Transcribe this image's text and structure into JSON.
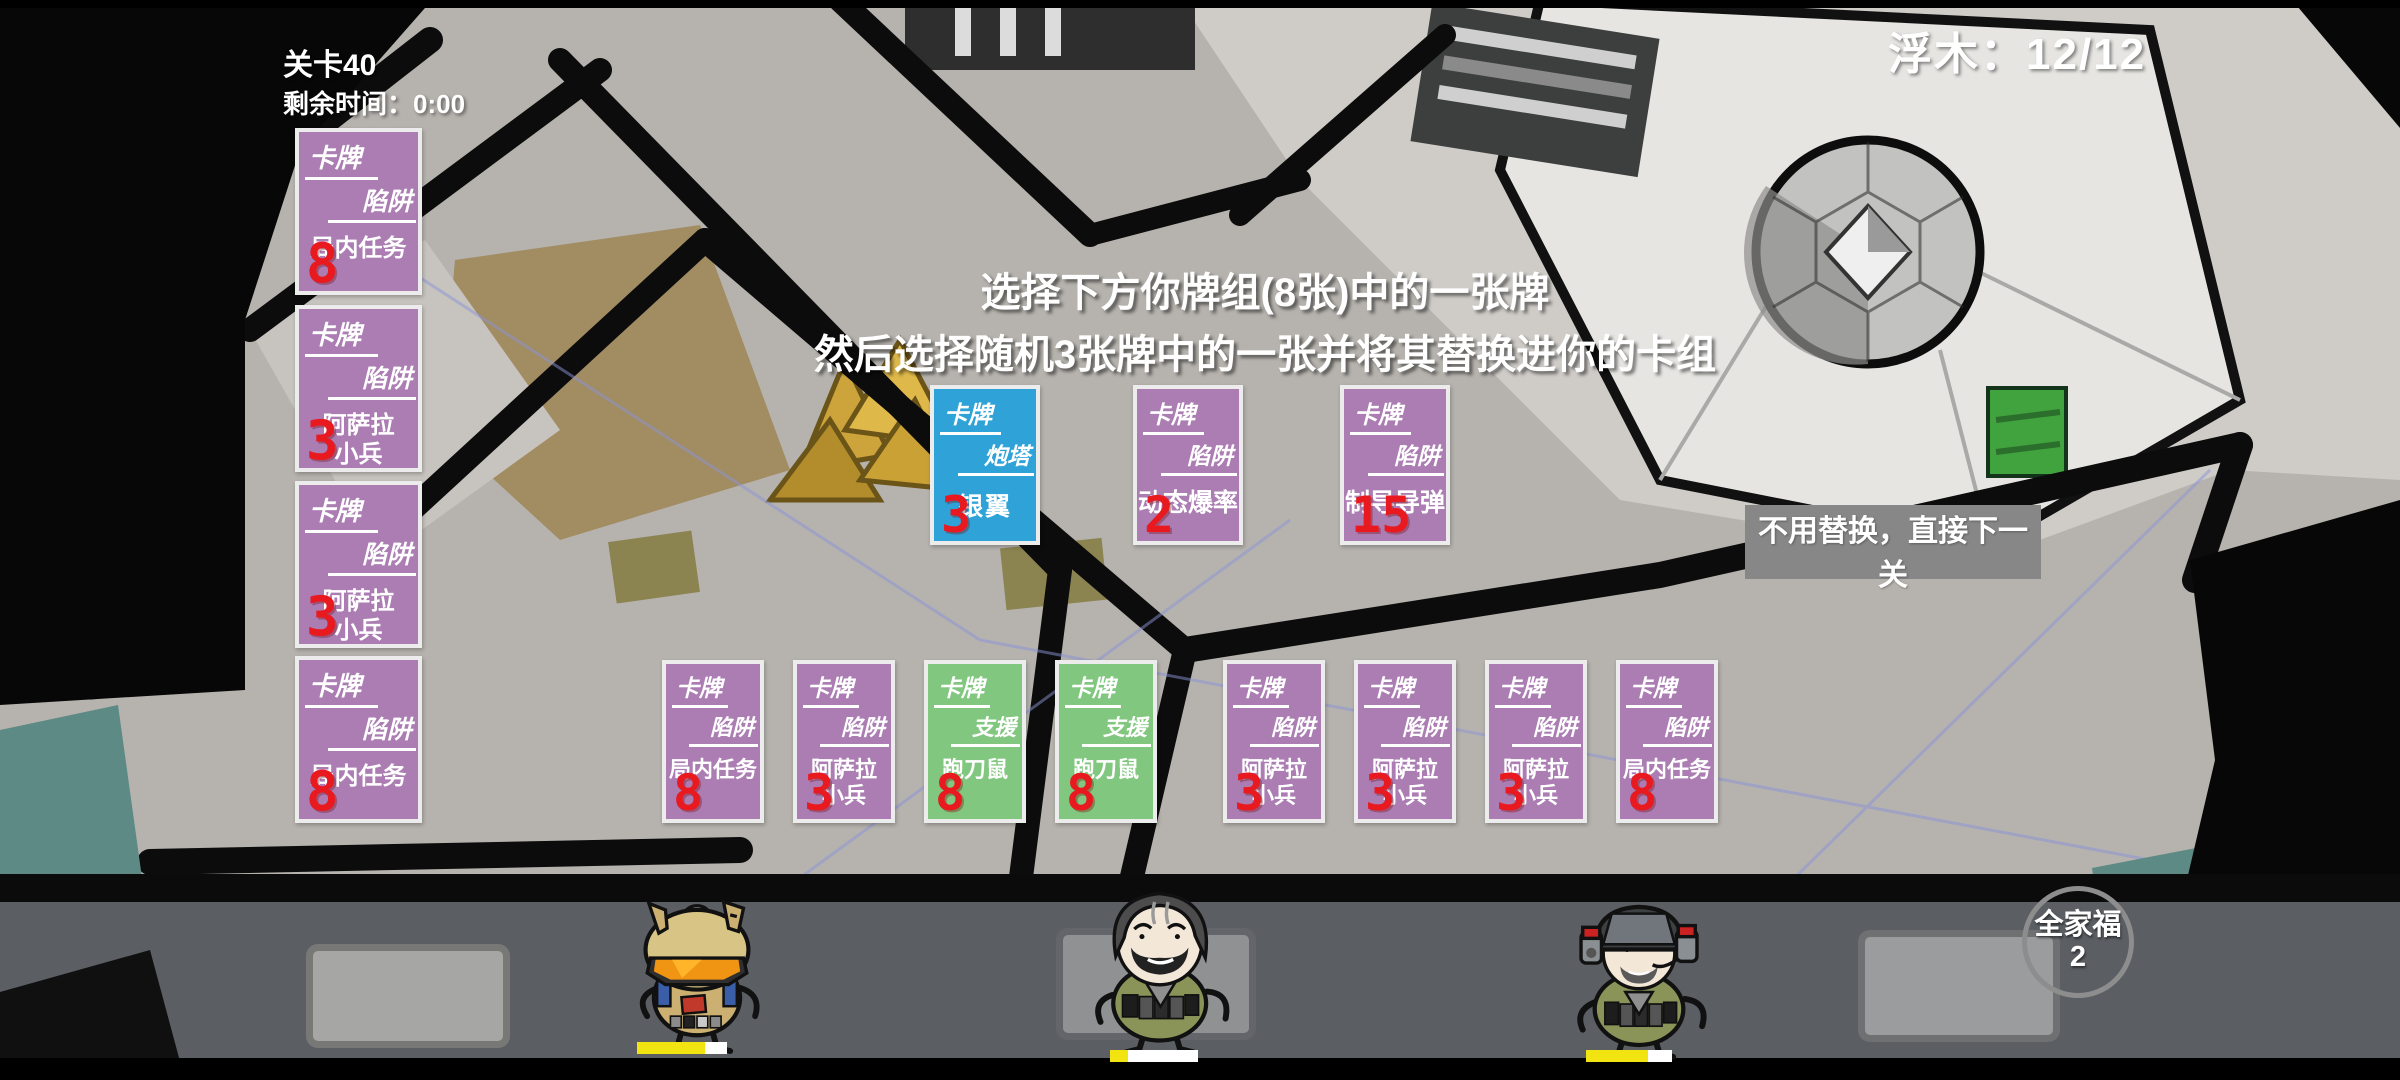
{
  "hud": {
    "level": "关卡40",
    "time": "剩余时间：0:00",
    "driftwood": "浮木：12/12"
  },
  "instruction": {
    "line1": "选择下方你牌组(8张)中的一张牌",
    "line2": "然后选择随机3张牌中的一张并将其替换进你的卡组"
  },
  "skip_button_label": "不用替换，直接下一关",
  "family_badge": {
    "label": "全家福",
    "count": "2"
  },
  "reserve_cards": [
    {
      "category": "卡牌",
      "type": "陷阱",
      "name": "局内任务",
      "name2": "",
      "count": "8"
    },
    {
      "category": "卡牌",
      "type": "陷阱",
      "name": "阿萨拉",
      "name2": "小兵",
      "count": "3"
    },
    {
      "category": "卡牌",
      "type": "陷阱",
      "name": "阿萨拉",
      "name2": "小兵",
      "count": "3"
    },
    {
      "category": "卡牌",
      "type": "陷阱",
      "name": "局内任务",
      "name2": "",
      "count": "8"
    }
  ],
  "offer_cards": [
    {
      "category": "卡牌",
      "type": "炮塔",
      "name": "银翼",
      "name2": "",
      "count": "3"
    },
    {
      "category": "卡牌",
      "type": "陷阱",
      "name": "动态爆率",
      "name2": "",
      "count": "2"
    },
    {
      "category": "卡牌",
      "type": "陷阱",
      "name": "制导导弹",
      "name2": "",
      "count": "15"
    }
  ],
  "deck_cards": [
    {
      "category": "卡牌",
      "type": "陷阱",
      "name": "局内任务",
      "name2": "",
      "count": "8"
    },
    {
      "category": "卡牌",
      "type": "陷阱",
      "name": "阿萨拉",
      "name2": "小兵",
      "count": "3"
    },
    {
      "category": "卡牌",
      "type": "支援",
      "name": "跑刀鼠",
      "name2": "",
      "count": "8"
    },
    {
      "category": "卡牌",
      "type": "支援",
      "name": "跑刀鼠",
      "name2": "",
      "count": "8"
    },
    {
      "category": "卡牌",
      "type": "陷阱",
      "name": "阿萨拉",
      "name2": "小兵",
      "count": "3"
    },
    {
      "category": "卡牌",
      "type": "陷阱",
      "name": "阿萨拉",
      "name2": "小兵",
      "count": "3"
    },
    {
      "category": "卡牌",
      "type": "陷阱",
      "name": "阿萨拉",
      "name2": "小兵",
      "count": "3"
    },
    {
      "category": "卡牌",
      "type": "陷阱",
      "name": "局内任务",
      "name2": "",
      "count": "8"
    }
  ],
  "health_bars": [
    {
      "percent": 76
    },
    {
      "percent": 20
    },
    {
      "percent": 72
    }
  ],
  "colors": {
    "card_purple": "#ab7db3",
    "card_blue": "#2fa3d7",
    "card_green": "#82c77f",
    "count_red": "#e81a20",
    "skip_button_gray": "#878787",
    "health_yellow": "#f2e411"
  }
}
